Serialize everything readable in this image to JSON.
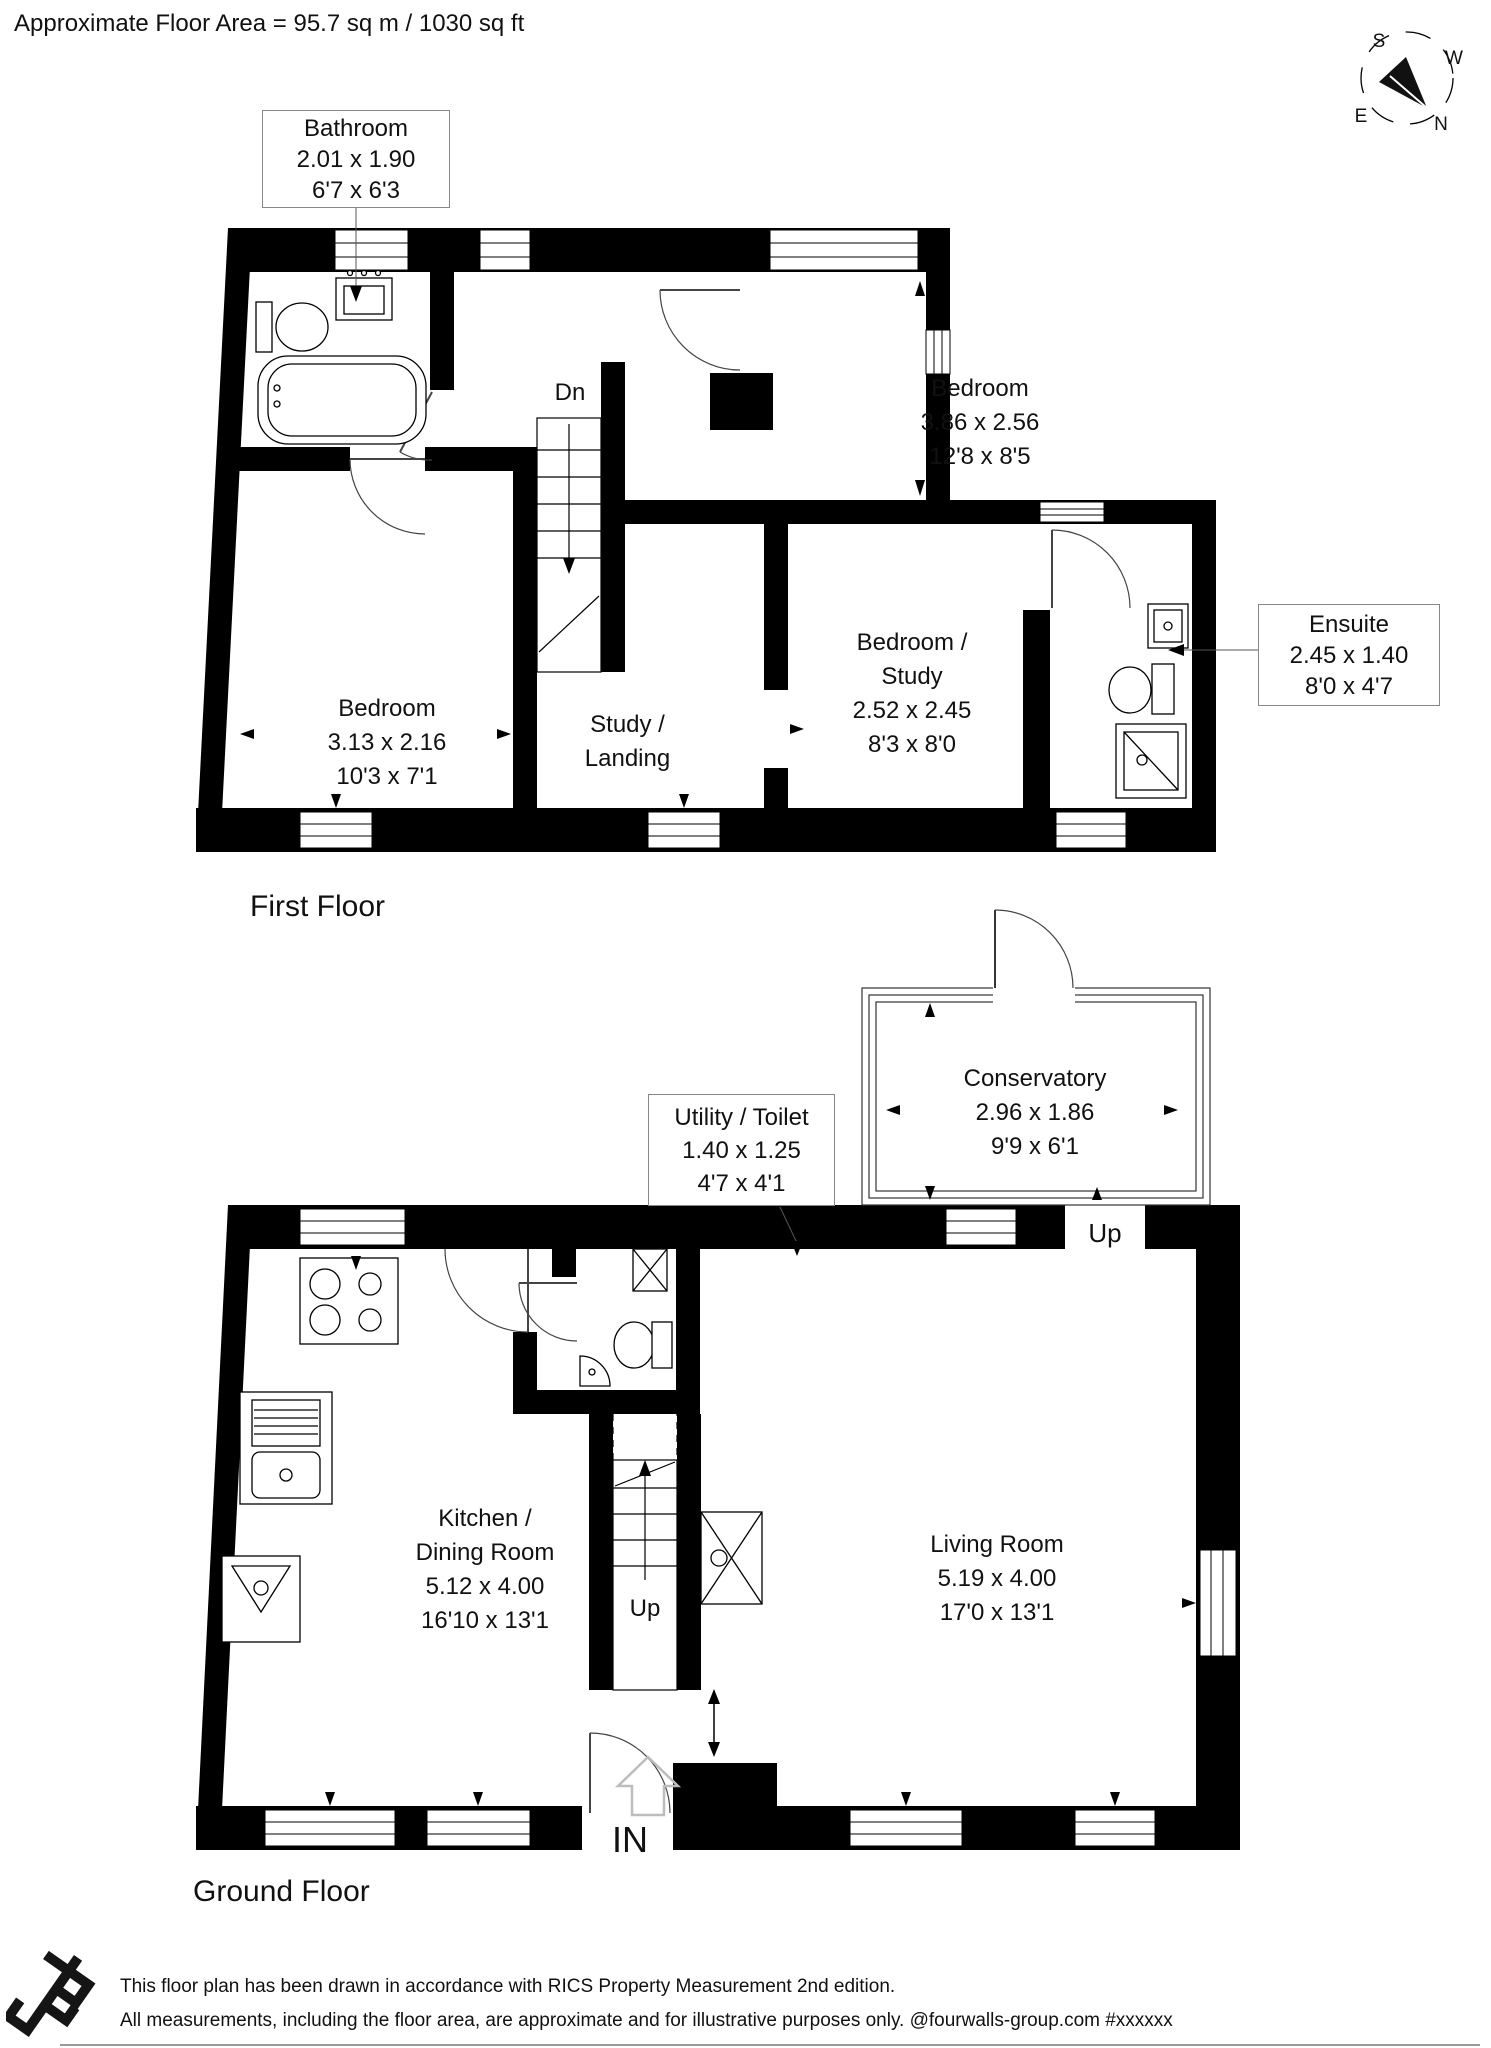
{
  "header": {
    "floor_area": "Approximate Floor Area = 95.7 sq m / 1030 sq ft"
  },
  "compass": {
    "n": "N",
    "s": "S",
    "e": "E",
    "w": "W"
  },
  "first_floor": {
    "title": "First Floor",
    "stairs_label": "Dn",
    "rooms": {
      "bathroom": {
        "name": "Bathroom",
        "dims_m": "2.01 x 1.90",
        "dims_ft": "6'7 x 6'3"
      },
      "bedroom_right": {
        "name": "Bedroom",
        "dims_m": "3.86 x 2.56",
        "dims_ft": "12'8 x 8'5"
      },
      "bedroom_left": {
        "name": "Bedroom",
        "dims_m": "3.13 x 2.16",
        "dims_ft": "10'3 x 7'1"
      },
      "study_landing": {
        "name_line1": "Study /",
        "name_line2": "Landing"
      },
      "bedroom_study": {
        "name_line1": "Bedroom /",
        "name_line2": "Study",
        "dims_m": "2.52 x 2.45",
        "dims_ft": "8'3 x 8'0"
      },
      "ensuite": {
        "name": "Ensuite",
        "dims_m": "2.45 x 1.40",
        "dims_ft": "8'0 x 4'7"
      }
    }
  },
  "ground_floor": {
    "title": "Ground Floor",
    "stairs_label": "Up",
    "conservatory_entry_label": "Up",
    "entrance_label": "IN",
    "rooms": {
      "utility_toilet": {
        "name": "Utility / Toilet",
        "dims_m": "1.40 x 1.25",
        "dims_ft": "4'7 x 4'1"
      },
      "conservatory": {
        "name": "Conservatory",
        "dims_m": "2.96 x 1.86",
        "dims_ft": "9'9 x 6'1"
      },
      "kitchen_dining": {
        "name_line1": "Kitchen /",
        "name_line2": "Dining Room",
        "dims_m": "5.12 x 4.00",
        "dims_ft": "16'10 x 13'1"
      },
      "living_room": {
        "name": "Living Room",
        "dims_m": "5.19 x 4.00",
        "dims_ft": "17'0 x 13'1"
      }
    }
  },
  "footer": {
    "line1": "This floor plan has been drawn in accordance with RICS Property Measurement 2nd edition.",
    "line2": "All measurements, including the floor area, are approximate and for illustrative purposes only. @fourwalls-group.com #xxxxxx"
  }
}
